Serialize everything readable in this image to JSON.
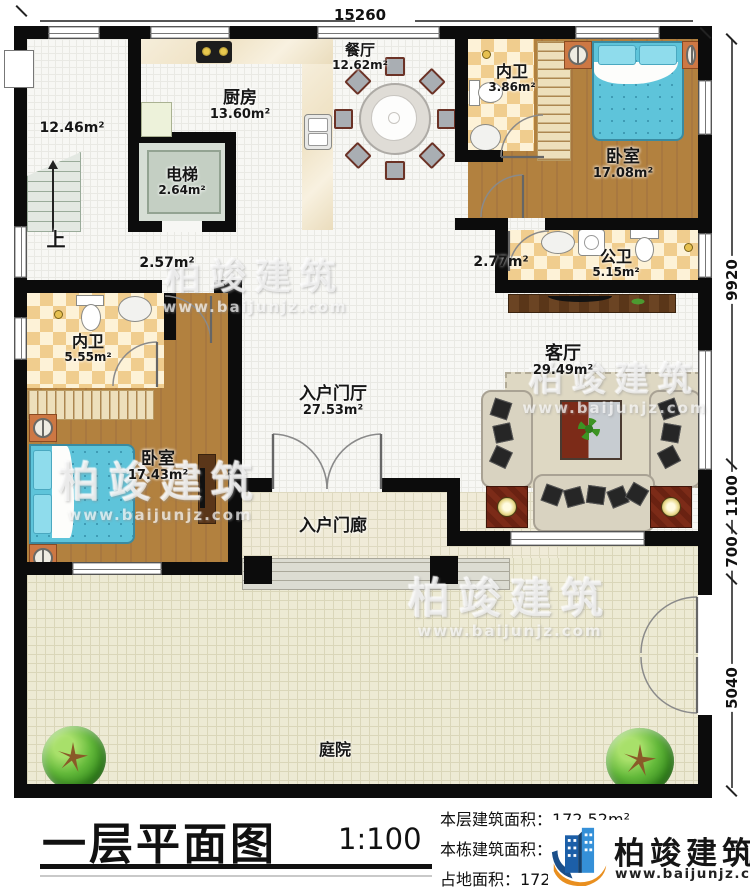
{
  "plan": {
    "dim_top": "15260",
    "dim_right_1": "9920",
    "dim_right_2": "1100",
    "dim_right_3": "700",
    "dim_right_4": "5040"
  },
  "rooms": {
    "storage": {
      "area": "12.46m²"
    },
    "stairs": {
      "label": "上"
    },
    "elevator": {
      "name": "电梯",
      "area": "2.64m²"
    },
    "kitchen": {
      "name": "厨房",
      "area": "13.60m²"
    },
    "dining": {
      "name": "餐厅",
      "area": "12.62m²"
    },
    "bath_top": {
      "name": "内卫",
      "area": "3.86m²"
    },
    "bed_top": {
      "name": "卧室",
      "area": "17.08m²"
    },
    "pub_bath": {
      "name": "公卫",
      "area": "5.15m²"
    },
    "hall_l": {
      "area": "2.57m²"
    },
    "hall_r": {
      "area": "2.77m²"
    },
    "bath_left": {
      "name": "内卫",
      "area": "5.55m²"
    },
    "bed_left": {
      "name": "卧室",
      "area": "17.43m²"
    },
    "foyer": {
      "name": "入户门厅",
      "area": "27.53m²"
    },
    "living": {
      "name": "客厅",
      "area": "29.49m²"
    },
    "porch": {
      "name": "入户门廊"
    },
    "courtyard": {
      "name": "庭院"
    }
  },
  "watermark": {
    "name": "柏竣建筑",
    "url": "www.baijunjz.com"
  },
  "footer": {
    "title": "一层平面图",
    "scale": "1:100",
    "stats": {
      "floor_area": "本层建筑面积：172.52m²",
      "building_area": "本栋建筑面积：485.37m²（不含庭院面积）",
      "land_area": "占地面积：172.52m²  层高：3.6m"
    },
    "logo_name": "柏竣建筑",
    "logo_url": "www.baijunjz.com"
  }
}
